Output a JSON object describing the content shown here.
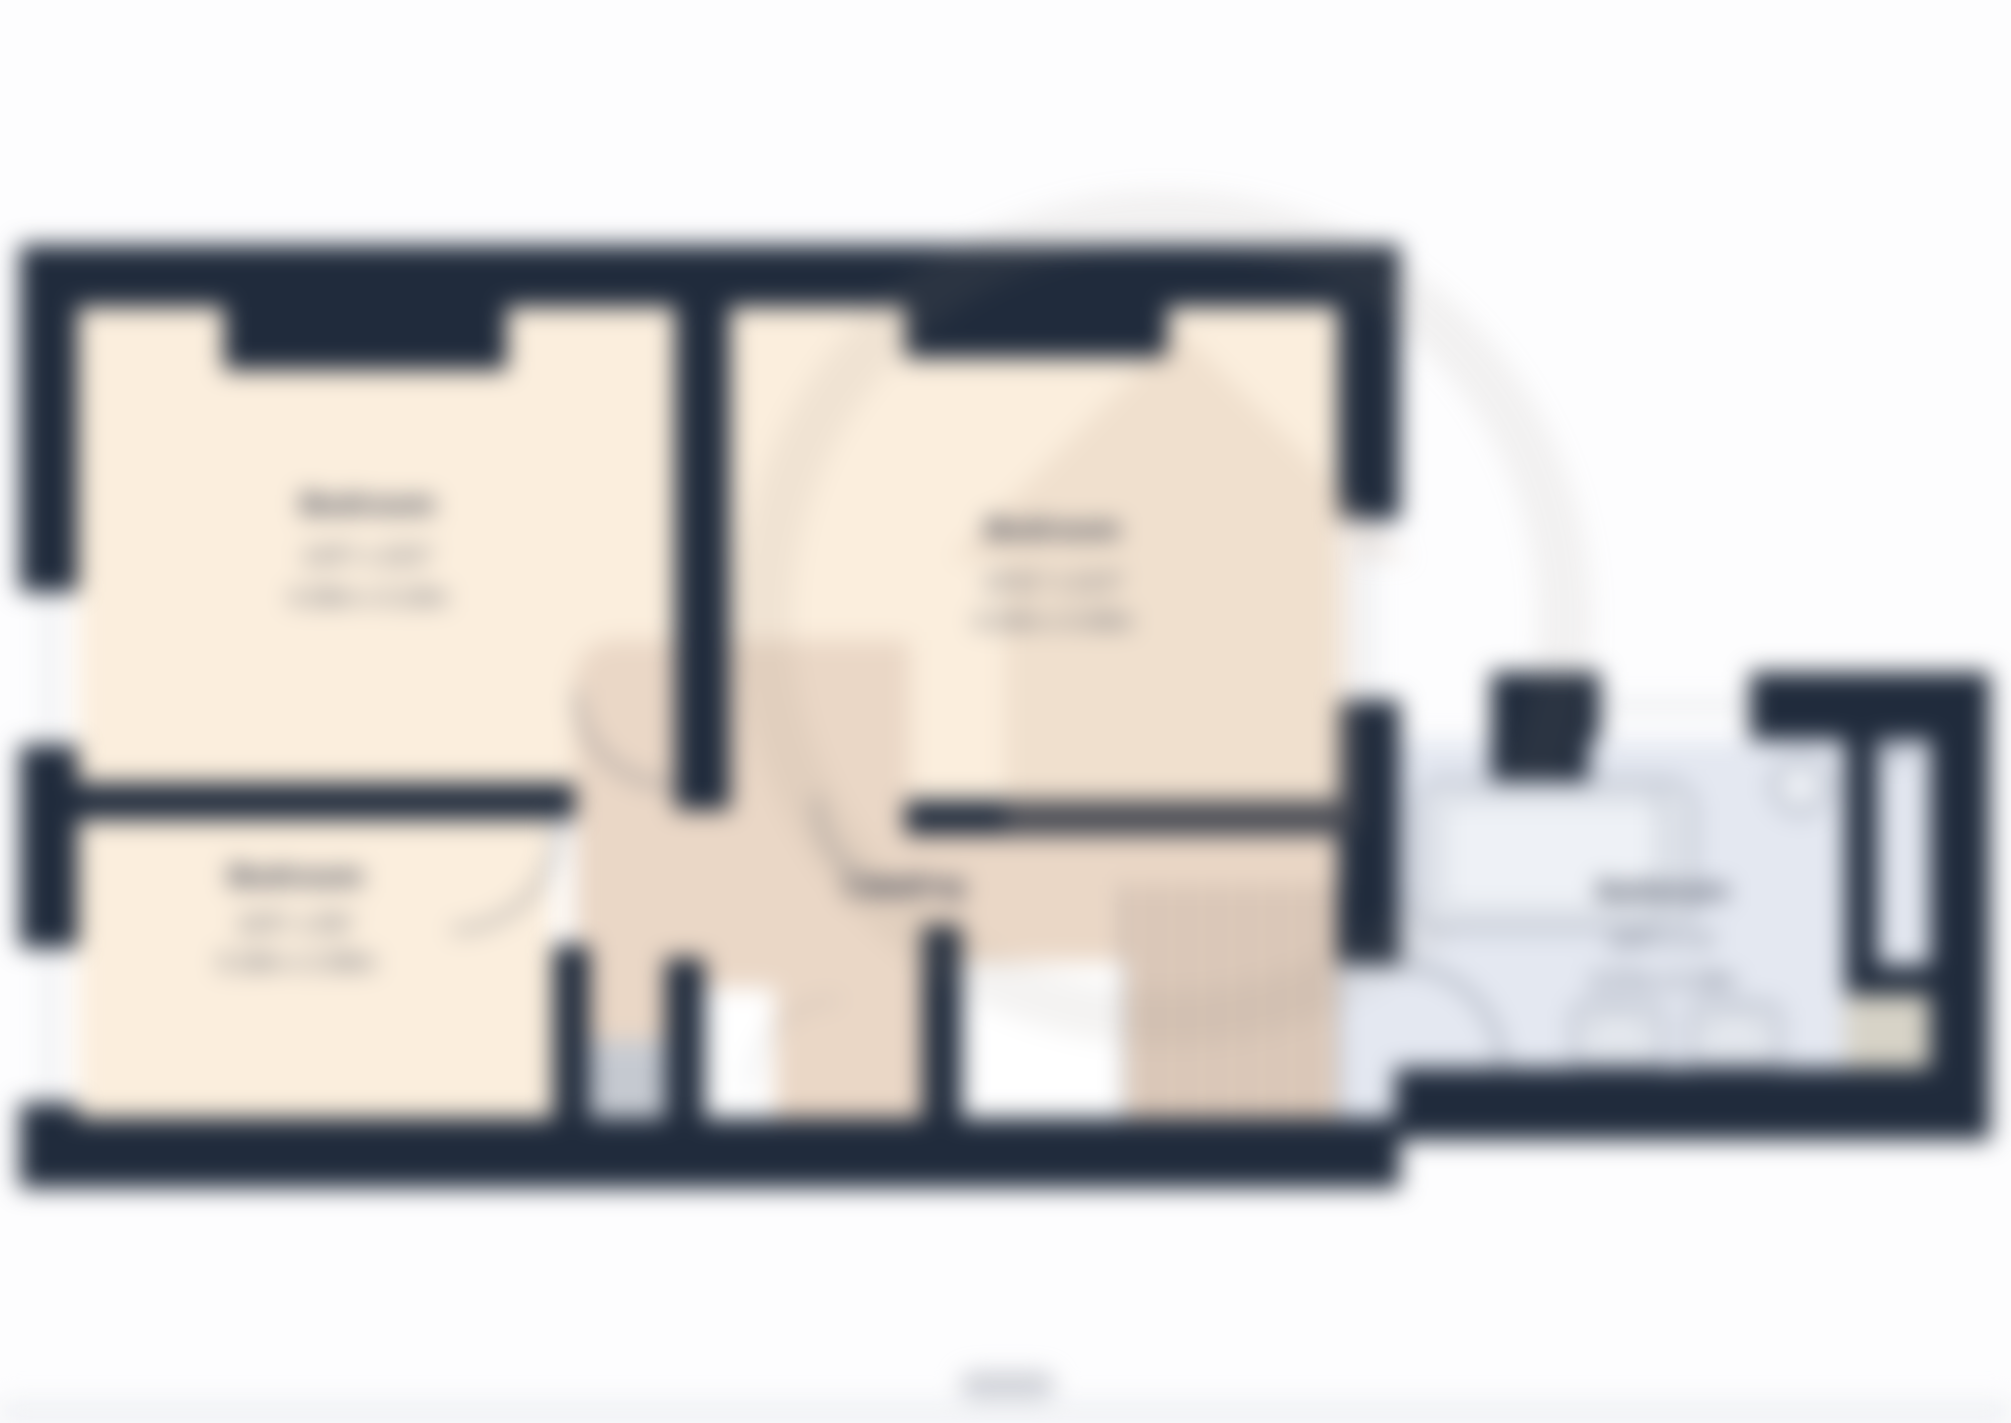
{
  "floorplan": {
    "rooms": [
      {
        "id": "bedroom-1",
        "label": "Bedroom",
        "dim_imperial": "14'0\" x 10'2\"",
        "dim_metric": "4.26m x 3.10m"
      },
      {
        "id": "bedroom-2",
        "label": "Bedroom",
        "dim_imperial": "13'11\" x 11'2\"",
        "dim_metric": "4.24m x 3.40m"
      },
      {
        "id": "bedroom-3",
        "label": "Bedroom",
        "dim_imperial": "10'5\" x 9'6\"",
        "dim_metric": "3.18m x 2.90m"
      },
      {
        "id": "landing",
        "label": "Landing"
      },
      {
        "id": "bathroom",
        "label": "Bathroom",
        "dim_imperial": "10'9\" x 7'2\"",
        "dim_metric": "3.27m x 2.18m"
      }
    ],
    "colors": {
      "wall": "#202b3c",
      "bedroom_floor": "#fbeedd",
      "landing_floor": "#ead7c6",
      "bathroom_floor": "#e4e8f1",
      "window": "#ffffff",
      "shower_tray_beige": "#d7d3c7",
      "sill_gray": "#c7cbd2"
    }
  }
}
